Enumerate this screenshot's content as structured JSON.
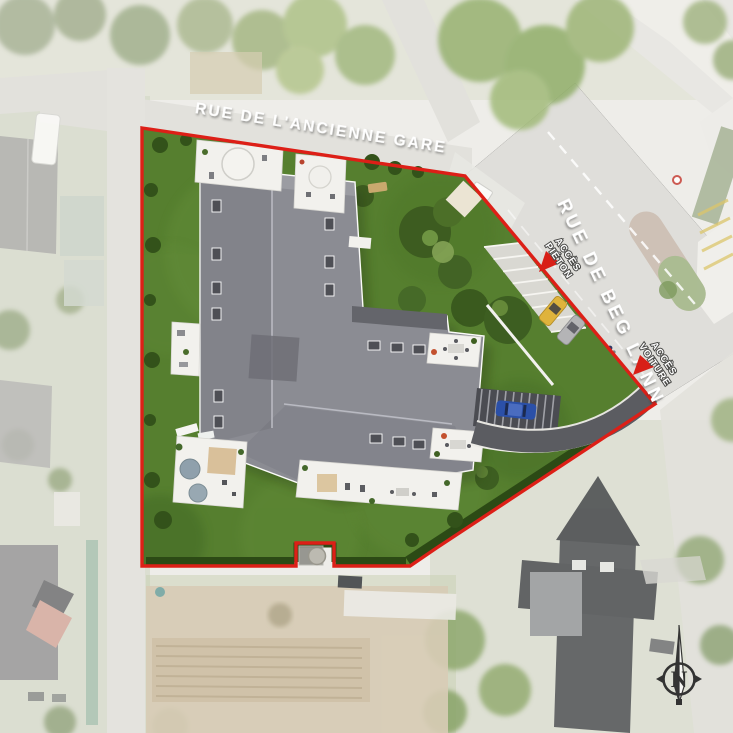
{
  "labels": {
    "street_top": "RUE DE L'ANCIENNE GARE",
    "street_right": "RUE DE BEG LANN",
    "access_pedestrian_line1": "ACCÈS",
    "access_pedestrian_line2": "PIÉTON",
    "access_car_line1": "ACCÈS",
    "access_car_line2": "VOITURE",
    "compass_north": "N"
  },
  "colors": {
    "site_boundary_red": "#dd1f17",
    "lawn_green": "#567f2f",
    "hedge_green": "#2c4a15",
    "roof_gray": "#8b8c93",
    "terrace_white": "#f2f1ed",
    "road_gray": "#e0dfdb",
    "driveway_gray": "#5b5c61",
    "arrow_red": "#d81f17"
  }
}
